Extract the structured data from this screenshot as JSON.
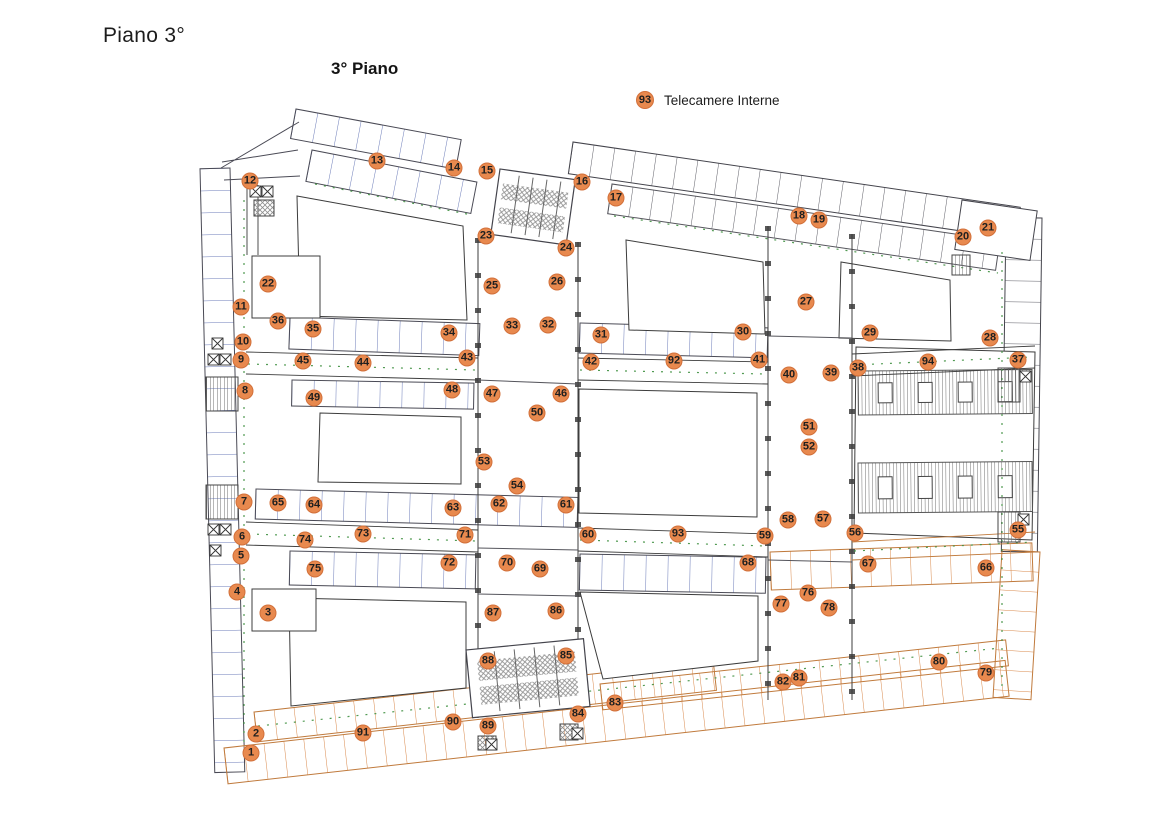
{
  "page": {
    "title": "Piano 3°",
    "map_title": "3° Piano"
  },
  "legend": {
    "number": "93",
    "label": "Telecamere Interne"
  },
  "colors": {
    "marker_fill": "#E8894E",
    "marker_border": "#D2703A",
    "marker_text": "#1F1F1F",
    "plan_blue": "#5A6CB0",
    "plan_black": "#44444C",
    "plan_orange": "#D8884A",
    "plan_green": "#3F9040",
    "plan_hatch": "#8F8F8F"
  },
  "markers": [
    {
      "n": "1",
      "x": 251,
      "y": 753
    },
    {
      "n": "2",
      "x": 256,
      "y": 734
    },
    {
      "n": "3",
      "x": 268,
      "y": 613
    },
    {
      "n": "4",
      "x": 237,
      "y": 592
    },
    {
      "n": "5",
      "x": 241,
      "y": 556
    },
    {
      "n": "6",
      "x": 242,
      "y": 537
    },
    {
      "n": "7",
      "x": 244,
      "y": 502
    },
    {
      "n": "8",
      "x": 245,
      "y": 391
    },
    {
      "n": "9",
      "x": 241,
      "y": 360
    },
    {
      "n": "10",
      "x": 243,
      "y": 342
    },
    {
      "n": "11",
      "x": 241,
      "y": 307
    },
    {
      "n": "12",
      "x": 250,
      "y": 181
    },
    {
      "n": "13",
      "x": 377,
      "y": 161
    },
    {
      "n": "14",
      "x": 454,
      "y": 168
    },
    {
      "n": "15",
      "x": 487,
      "y": 171
    },
    {
      "n": "16",
      "x": 582,
      "y": 182
    },
    {
      "n": "17",
      "x": 616,
      "y": 198
    },
    {
      "n": "18",
      "x": 799,
      "y": 216
    },
    {
      "n": "19",
      "x": 819,
      "y": 220
    },
    {
      "n": "20",
      "x": 963,
      "y": 237
    },
    {
      "n": "21",
      "x": 988,
      "y": 228
    },
    {
      "n": "22",
      "x": 268,
      "y": 284
    },
    {
      "n": "23",
      "x": 486,
      "y": 236
    },
    {
      "n": "24",
      "x": 566,
      "y": 248
    },
    {
      "n": "25",
      "x": 492,
      "y": 286
    },
    {
      "n": "26",
      "x": 557,
      "y": 282
    },
    {
      "n": "27",
      "x": 806,
      "y": 302
    },
    {
      "n": "28",
      "x": 990,
      "y": 338
    },
    {
      "n": "29",
      "x": 870,
      "y": 333
    },
    {
      "n": "30",
      "x": 743,
      "y": 332
    },
    {
      "n": "31",
      "x": 601,
      "y": 335
    },
    {
      "n": "32",
      "x": 548,
      "y": 325
    },
    {
      "n": "33",
      "x": 512,
      "y": 326
    },
    {
      "n": "34",
      "x": 449,
      "y": 333
    },
    {
      "n": "35",
      "x": 313,
      "y": 329
    },
    {
      "n": "36",
      "x": 278,
      "y": 321
    },
    {
      "n": "37",
      "x": 1018,
      "y": 360
    },
    {
      "n": "38",
      "x": 858,
      "y": 368
    },
    {
      "n": "39",
      "x": 831,
      "y": 373
    },
    {
      "n": "40",
      "x": 789,
      "y": 375
    },
    {
      "n": "41",
      "x": 759,
      "y": 360
    },
    {
      "n": "42",
      "x": 591,
      "y": 362
    },
    {
      "n": "43",
      "x": 467,
      "y": 358
    },
    {
      "n": "44",
      "x": 363,
      "y": 363
    },
    {
      "n": "45",
      "x": 303,
      "y": 361
    },
    {
      "n": "46",
      "x": 561,
      "y": 394
    },
    {
      "n": "47",
      "x": 492,
      "y": 394
    },
    {
      "n": "48",
      "x": 452,
      "y": 390
    },
    {
      "n": "49",
      "x": 314,
      "y": 398
    },
    {
      "n": "50",
      "x": 537,
      "y": 413
    },
    {
      "n": "51",
      "x": 809,
      "y": 427
    },
    {
      "n": "52",
      "x": 809,
      "y": 447
    },
    {
      "n": "53",
      "x": 484,
      "y": 462
    },
    {
      "n": "54",
      "x": 517,
      "y": 486
    },
    {
      "n": "55",
      "x": 1018,
      "y": 530
    },
    {
      "n": "56",
      "x": 855,
      "y": 533
    },
    {
      "n": "57",
      "x": 823,
      "y": 519
    },
    {
      "n": "58",
      "x": 788,
      "y": 520
    },
    {
      "n": "59",
      "x": 765,
      "y": 536
    },
    {
      "n": "60",
      "x": 588,
      "y": 535
    },
    {
      "n": "61",
      "x": 566,
      "y": 505
    },
    {
      "n": "62",
      "x": 499,
      "y": 504
    },
    {
      "n": "63",
      "x": 453,
      "y": 508
    },
    {
      "n": "64",
      "x": 314,
      "y": 505
    },
    {
      "n": "65",
      "x": 278,
      "y": 503
    },
    {
      "n": "66",
      "x": 986,
      "y": 568
    },
    {
      "n": "67",
      "x": 868,
      "y": 564
    },
    {
      "n": "68",
      "x": 748,
      "y": 563
    },
    {
      "n": "69",
      "x": 540,
      "y": 569
    },
    {
      "n": "70",
      "x": 507,
      "y": 563
    },
    {
      "n": "71",
      "x": 465,
      "y": 535
    },
    {
      "n": "72",
      "x": 449,
      "y": 563
    },
    {
      "n": "73",
      "x": 363,
      "y": 534
    },
    {
      "n": "74",
      "x": 305,
      "y": 540
    },
    {
      "n": "75",
      "x": 315,
      "y": 569
    },
    {
      "n": "76",
      "x": 808,
      "y": 593
    },
    {
      "n": "77",
      "x": 781,
      "y": 604
    },
    {
      "n": "78",
      "x": 829,
      "y": 608
    },
    {
      "n": "79",
      "x": 986,
      "y": 673
    },
    {
      "n": "80",
      "x": 939,
      "y": 662
    },
    {
      "n": "81",
      "x": 799,
      "y": 678
    },
    {
      "n": "82",
      "x": 783,
      "y": 682
    },
    {
      "n": "83",
      "x": 615,
      "y": 703
    },
    {
      "n": "84",
      "x": 578,
      "y": 714
    },
    {
      "n": "85",
      "x": 566,
      "y": 656
    },
    {
      "n": "86",
      "x": 556,
      "y": 611
    },
    {
      "n": "87",
      "x": 493,
      "y": 613
    },
    {
      "n": "88",
      "x": 488,
      "y": 661
    },
    {
      "n": "89",
      "x": 488,
      "y": 726
    },
    {
      "n": "90",
      "x": 453,
      "y": 722
    },
    {
      "n": "91",
      "x": 363,
      "y": 733
    },
    {
      "n": "92",
      "x": 674,
      "y": 361
    },
    {
      "n": "93",
      "x": 678,
      "y": 534
    },
    {
      "n": "94",
      "x": 928,
      "y": 362
    }
  ]
}
